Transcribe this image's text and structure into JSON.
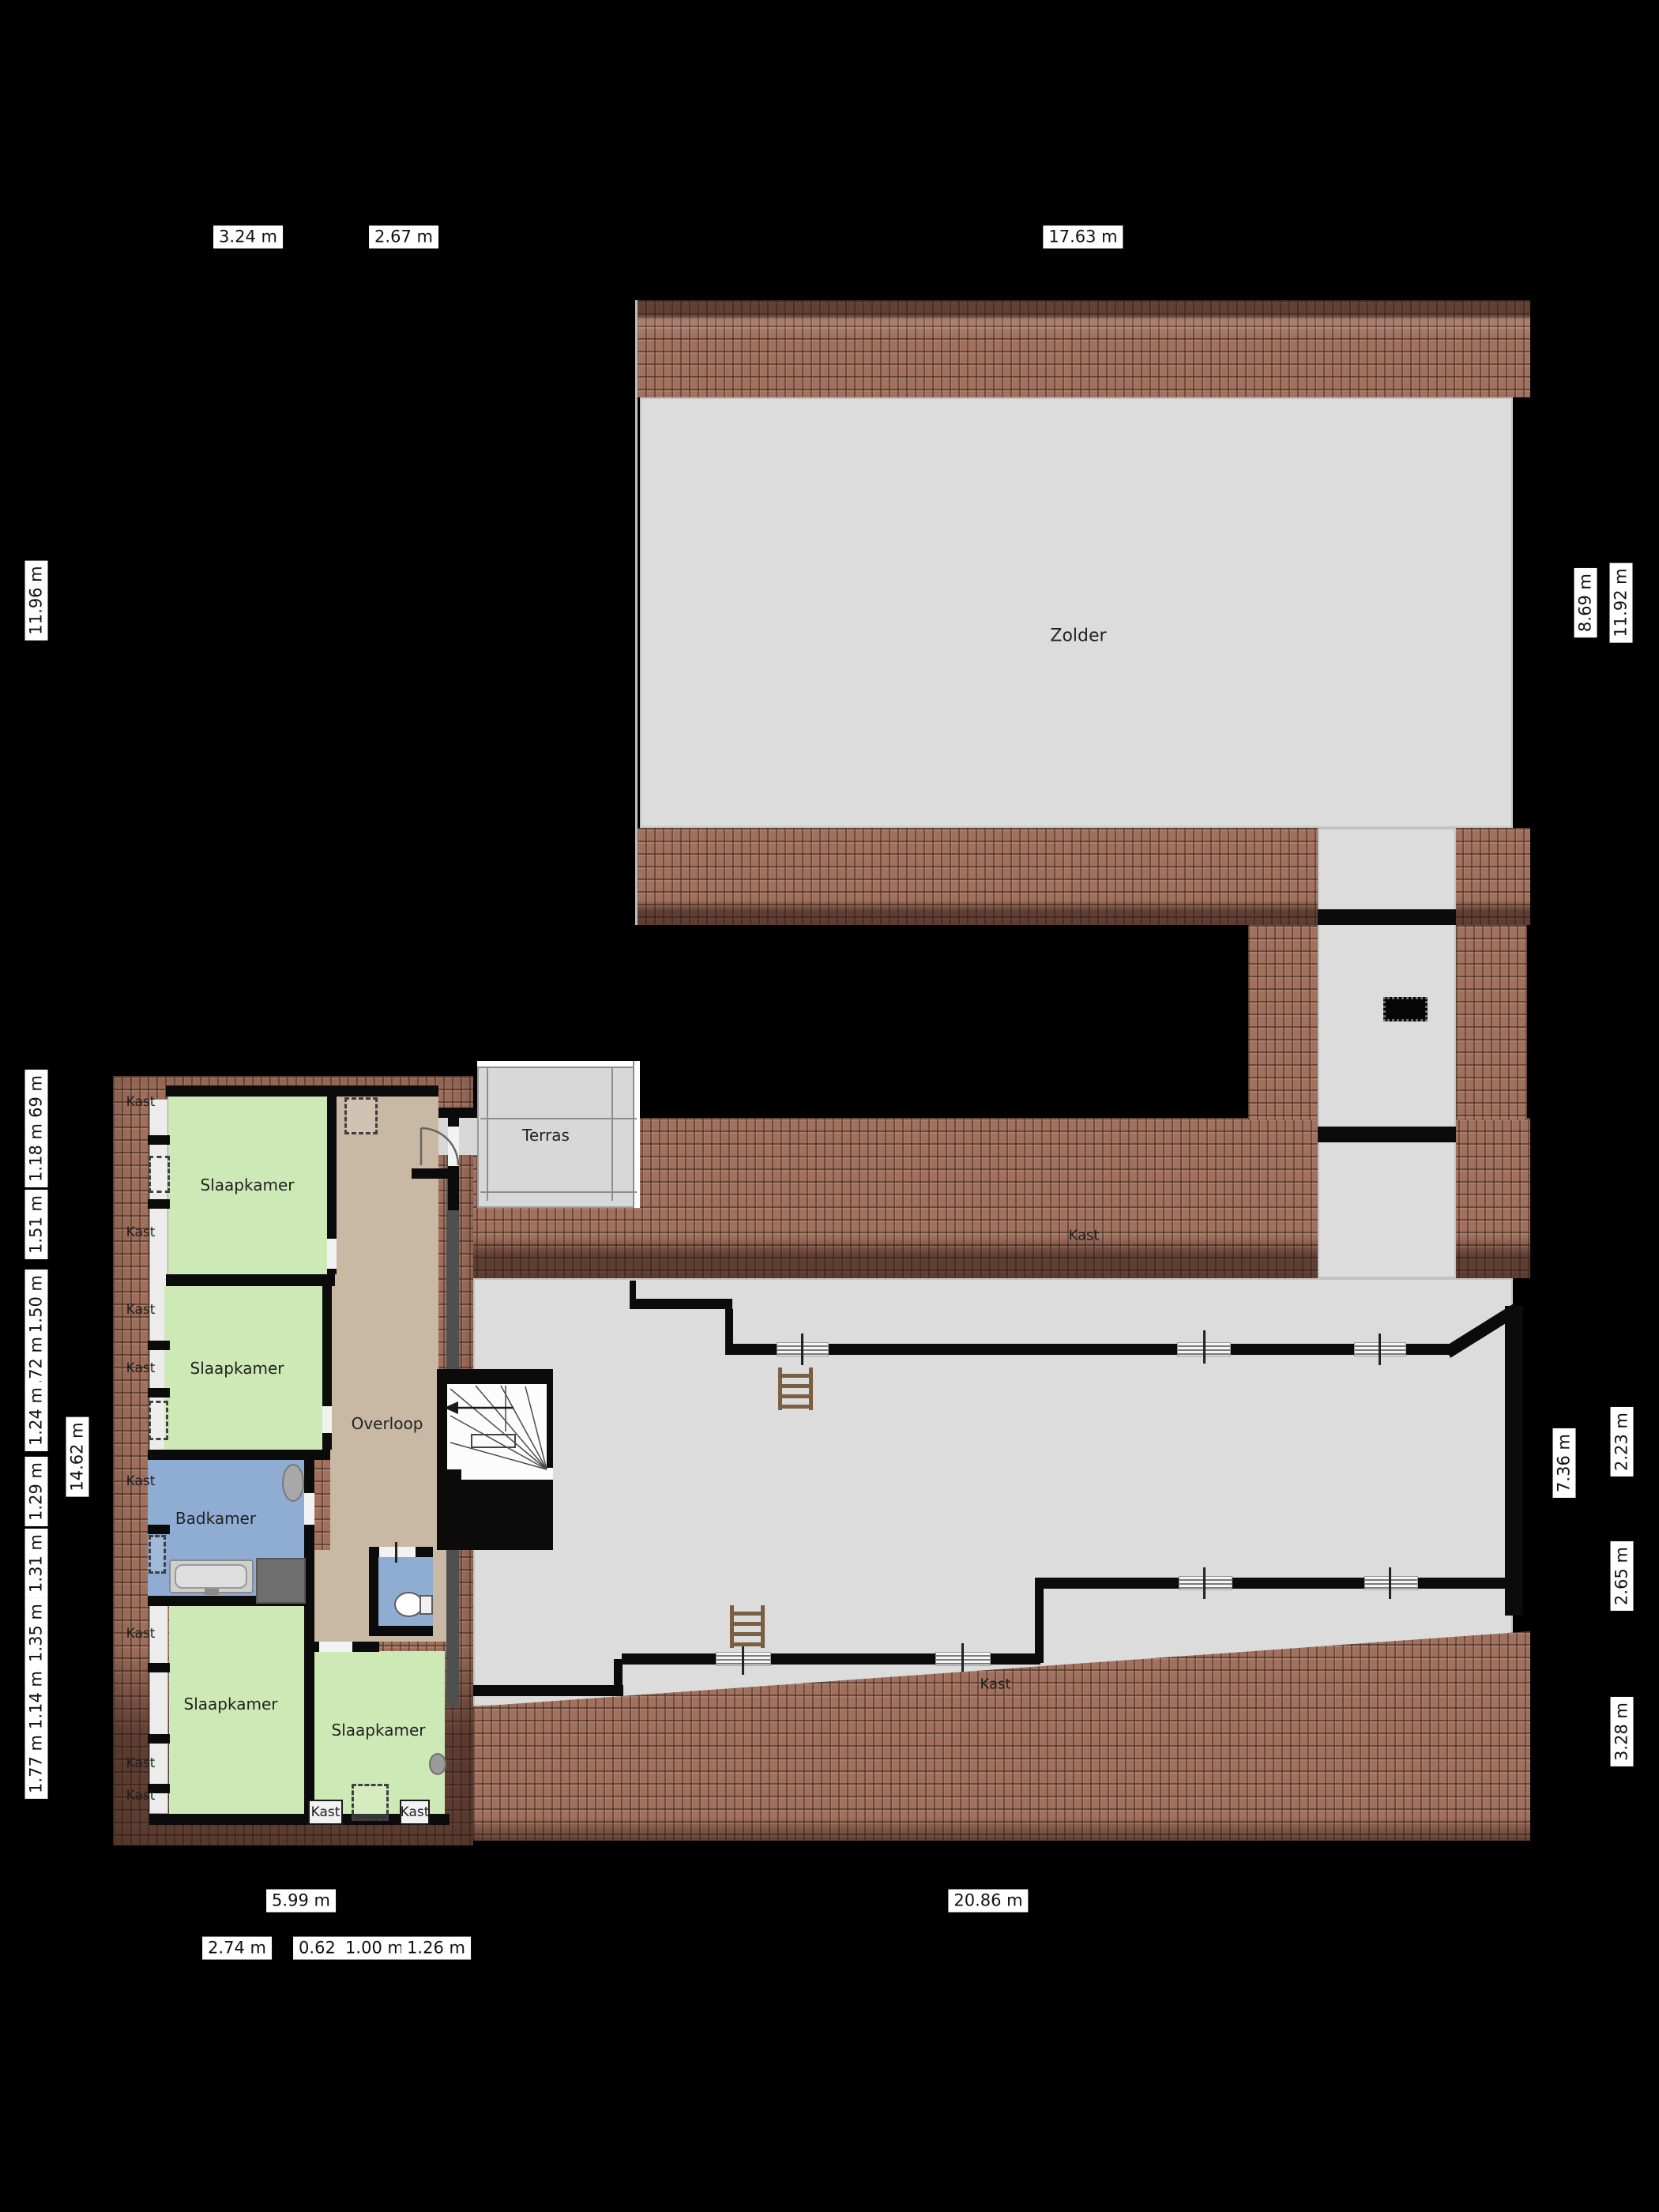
{
  "labels": {
    "zolder": "Zolder",
    "slaapkamer": "Slaapkamer",
    "badkamer": "Badkamer",
    "overloop": "Overloop",
    "terras": "Terras",
    "kast": "Kast"
  },
  "dimensions": {
    "top": [
      "3.24 m",
      "2.67 m",
      "17.63 m"
    ],
    "left_outer": [
      "11.96 m",
      "0.69 m",
      "1.18 m",
      "1.51 m",
      "1.50 m",
      "0.72 m",
      "1.24 m",
      "1.29 m",
      "1.31 m",
      "1.35 m",
      "1.14 m",
      "1.77 m"
    ],
    "left_inner": [
      "14.62 m"
    ],
    "right": [
      "8.69 m",
      "11.92 m",
      "7.36 m",
      "2.23 m",
      "2.65 m",
      "3.28 m"
    ],
    "bottom": [
      "5.99 m",
      "20.86 m",
      "2.74 m",
      "0.62 m",
      "1.00 m",
      "1.26 m"
    ]
  },
  "colors": {
    "background": "#000000",
    "floor": "#dcdcdc",
    "bedroom": "#cde9b5",
    "landing": "#c9b8a4",
    "bathroom": "#8fadd3",
    "roof_tiles": "#a1715e",
    "terrace": "#d8d8d8",
    "shower": "#6f6f6f"
  }
}
